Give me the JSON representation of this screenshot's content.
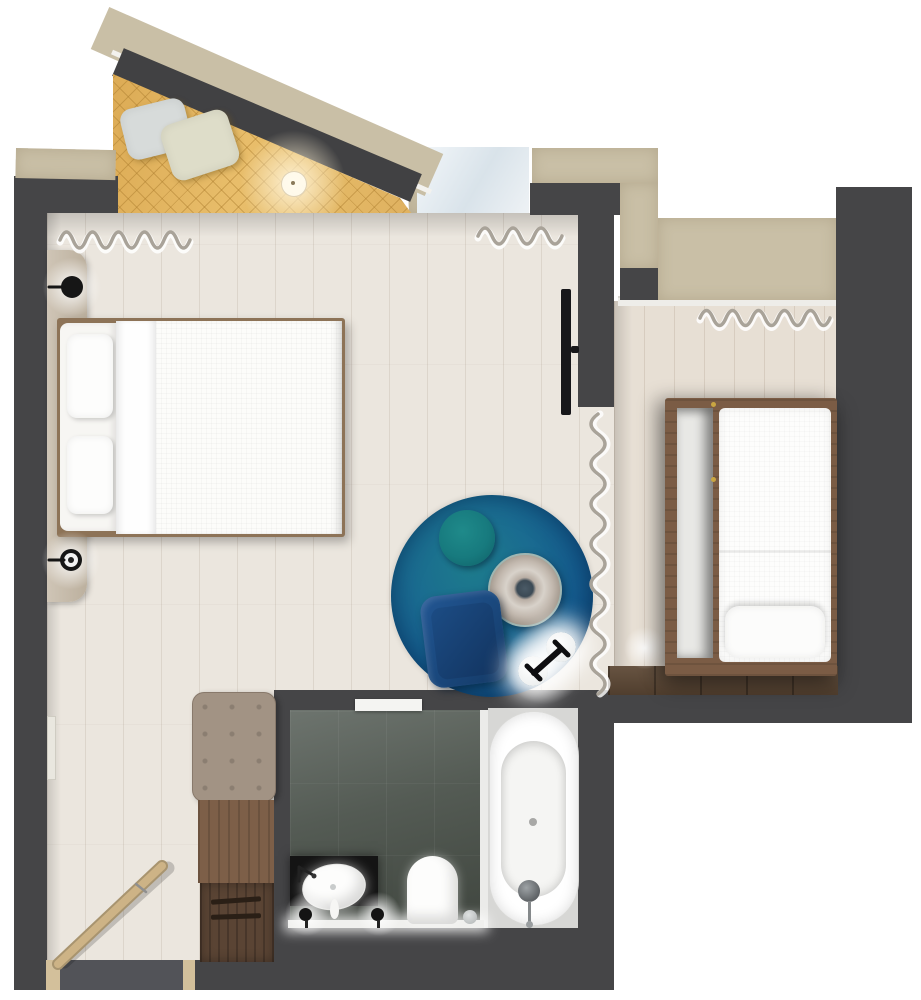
{
  "meta": {
    "title": "hotel-guestroom-floor-plan",
    "view": "top-down-rendered-plan",
    "canvas_width": 921,
    "canvas_height": 1000,
    "background": "#ffffff",
    "visible_text": "none"
  },
  "palette": {
    "outer_wall_beige": "#c9bfa6",
    "inner_wall_dark": "#454547",
    "bedroom_floor": "#ebe6de",
    "second_room_floor": "#e7dfd4",
    "daybed_gold": "#e2b260",
    "quilt_line_gold": "#ab7c2d",
    "rug_deep_blue": "#10497c",
    "rug_teal": "#1d7b8c",
    "pouf_teal": "#177a7e",
    "armchair_navy": "#1b4a80",
    "bench_taupe": "#a29384",
    "wardrobe_wood": "#7d5f48",
    "wardrobe_wood_dark": "#5a4434",
    "bed_frame_wood": "#7b5c45",
    "step_wood": "#5e4936",
    "bathroom_tile": "#4b524c",
    "linen_white": "#fbfbfa",
    "window_glass": "#d9e3ea",
    "door_wood": "#cdb386",
    "warm_glow": "#fff3d6"
  },
  "structure": {
    "outer_walls": "plaster-beige-slabs",
    "inner_walls": "dark-gray",
    "windows": [
      "balcony-angled-window",
      "bedroom-window-with-curtain",
      "second-bedroom-window-with-curtain"
    ],
    "entry": "bottom-left-hinged-door"
  },
  "rooms": [
    {
      "name": "balcony-alcove",
      "items": [
        {
          "name": "quilted-daybed"
        },
        {
          "name": "cushion-gray"
        },
        {
          "name": "cushion-cream"
        },
        {
          "name": "ceiling-light"
        }
      ]
    },
    {
      "name": "master-bedroom",
      "items": [
        {
          "name": "double-bed"
        },
        {
          "name": "headboard-cushion-upper"
        },
        {
          "name": "headboard-cushion-lower"
        },
        {
          "name": "duvet"
        },
        {
          "name": "headboard-panel"
        },
        {
          "name": "wall-sconce-upper"
        },
        {
          "name": "wall-sconce-lower"
        },
        {
          "name": "window-curtain-left"
        },
        {
          "name": "window-curtain-right"
        },
        {
          "name": "wall-tv"
        },
        {
          "name": "round-rug"
        },
        {
          "name": "pouf"
        },
        {
          "name": "side-table"
        },
        {
          "name": "armchair"
        },
        {
          "name": "floor-lamp"
        },
        {
          "name": "divider-curtain"
        },
        {
          "name": "bench"
        },
        {
          "name": "wardrobe-upper"
        },
        {
          "name": "wardrobe-lower"
        },
        {
          "name": "entry-door"
        },
        {
          "name": "wall-mirror"
        }
      ]
    },
    {
      "name": "second-bedroom",
      "items": [
        {
          "name": "single-bed-frame"
        },
        {
          "name": "mattress"
        },
        {
          "name": "trundle-mattress"
        },
        {
          "name": "pillow"
        },
        {
          "name": "window-curtain"
        },
        {
          "name": "wood-step"
        }
      ]
    },
    {
      "name": "bathroom",
      "items": [
        {
          "name": "bathtub"
        },
        {
          "name": "tub-faucet"
        },
        {
          "name": "washbasin"
        },
        {
          "name": "vanity-counter"
        },
        {
          "name": "vanity-light-left"
        },
        {
          "name": "vanity-light-right"
        },
        {
          "name": "toilet"
        },
        {
          "name": "towel-hook"
        },
        {
          "name": "sliding-door"
        },
        {
          "name": "glass-partition"
        }
      ]
    }
  ]
}
